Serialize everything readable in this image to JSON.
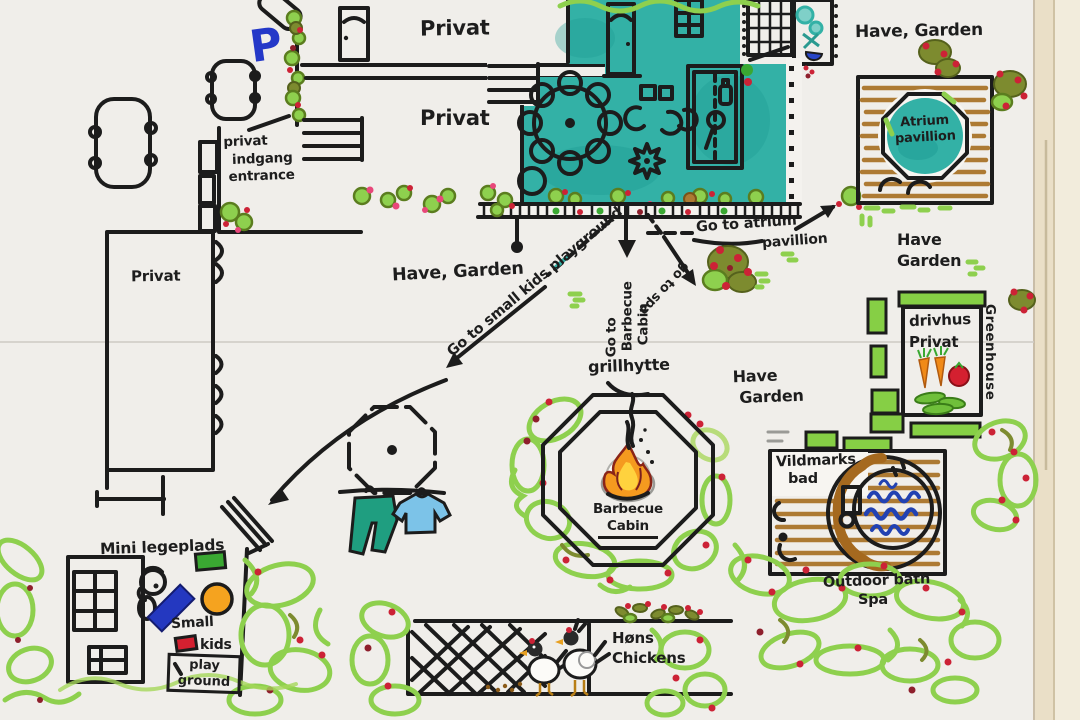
{
  "labels": {
    "parking_sign": "P",
    "room_top": "Privat",
    "room_mid": "Privat",
    "left_building": "Privat",
    "entrance_1": "privat",
    "entrance_2": "indgang",
    "entrance_3": "entrance",
    "have_garden_left": "Have, Garden",
    "have_garden_top_right": "Have, Garden",
    "have_right_1": "Have",
    "have_right_2": "Garden",
    "have_center_1": "Have",
    "have_center_2": "Garden",
    "atrium_1": "Atrium",
    "atrium_2": "pavillion",
    "go_playground": "Go to small kids playground",
    "go_barbecue_1": "Go to",
    "go_barbecue_2": "Barbecue",
    "go_barbecue_3": "Cabin",
    "go_spa": "go to spa",
    "go_atrium_1": "Go to atrium",
    "go_atrium_2": "pavillion",
    "grillhytte": "grillhytte",
    "cabin_1": "Barbecue",
    "cabin_2": "Cabin",
    "drivhus_1": "drivhus",
    "drivhus_2": "Privat",
    "greenhouse_en": "Greenhouse",
    "spa_da_1": "Vildmarks",
    "spa_da_2": "bad",
    "spa_en_1": "Outdoor bath",
    "spa_en_2": "Spa",
    "playground_title": "Mini legeplads",
    "small_kids_1": "Small",
    "small_kids_2": "kids",
    "playground_box_1": "play",
    "playground_box_2": "ground",
    "hens_da": "Høns",
    "hens_en": "Chickens"
  },
  "colors": {
    "teal": "#33b1a6",
    "light_green": "#8ed04e",
    "olive": "#7d8b2f",
    "berry_red": "#cc2236",
    "pink": "#e8477a",
    "wood_brown": "#ad7a33",
    "water_blue": "#aacae8",
    "wave_blue": "#2242b2",
    "orange": "#f5a31f",
    "marker_blue": "#2438c8",
    "window_yellow": "#e8b800",
    "ink": "#1c1c1c"
  }
}
